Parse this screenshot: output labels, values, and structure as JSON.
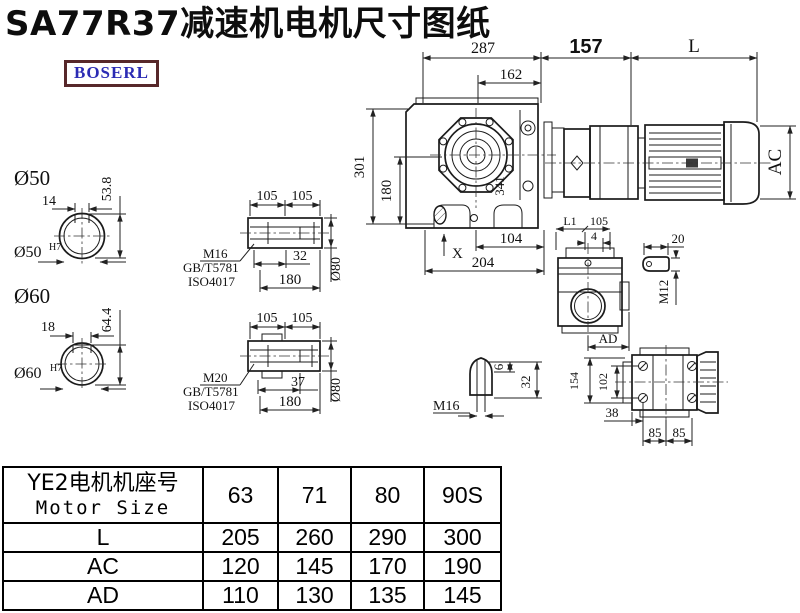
{
  "title": "SA77R37减速机电机尺寸图纸",
  "logo": {
    "text": "BOSERL"
  },
  "drawing": {
    "top_dims": {
      "d287": "287",
      "d162": "162",
      "d157": "157",
      "dL": "L"
    },
    "main_view": {
      "d301": "301",
      "d180": "180",
      "d341": "341",
      "dX": "X",
      "d104": "104",
      "d204": "204"
    },
    "motor_view": {
      "dAC": "AC"
    },
    "shaft50": {
      "label": "Ø50",
      "key_w": "14",
      "key_h": "53.8",
      "bore": "Ø50",
      "tol": "H7"
    },
    "shaft60": {
      "label": "Ø60",
      "key_w": "18",
      "key_h": "64.4",
      "bore": "Ø60",
      "tol": "H7"
    },
    "sleeve1": {
      "d105a": "105",
      "d105b": "105",
      "thread": "M16",
      "std1": "GB/T5781",
      "std2": "ISO4017",
      "d32": "32",
      "d180": "180",
      "dia": "Ø80"
    },
    "sleeve2": {
      "d105a": "105",
      "d105b": "105",
      "thread": "M20",
      "std1": "GB/T5781",
      "std2": "ISO4017",
      "d37": "37",
      "d180": "180",
      "dia": "Ø80"
    },
    "aux_view": {
      "dL1": "L1",
      "d105": "105",
      "d4": "4",
      "dAD": "AD"
    },
    "eyebolt": {
      "d20": "20",
      "thread": "M12"
    },
    "plug": {
      "d6": "6",
      "d32": "32",
      "thread": "M16"
    },
    "top_view": {
      "d154": "154",
      "d102": "102",
      "d38": "38",
      "d85a": "85",
      "d85b": "85"
    }
  },
  "table": {
    "header": {
      "motor_cn": "YE2电机机座号",
      "motor_en": "Motor Size",
      "sizes": [
        "63",
        "71",
        "80",
        "90S"
      ]
    },
    "rows": [
      {
        "label": "L",
        "values": [
          "205",
          "260",
          "290",
          "300"
        ]
      },
      {
        "label": "AC",
        "values": [
          "120",
          "145",
          "170",
          "190"
        ]
      },
      {
        "label": "AD",
        "values": [
          "110",
          "130",
          "135",
          "145"
        ]
      }
    ]
  }
}
